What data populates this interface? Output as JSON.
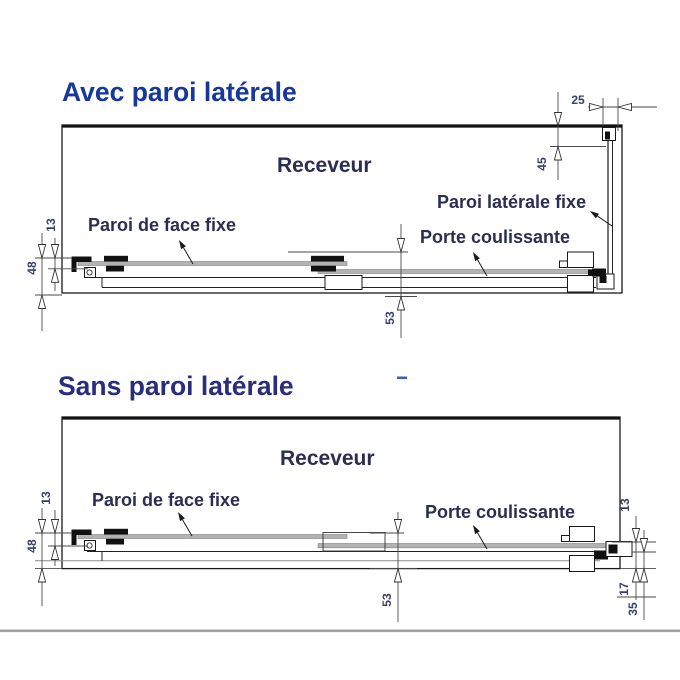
{
  "diagrams": {
    "top": {
      "title": "Avec paroi latérale",
      "tray_label": "Receveur",
      "front_panel_label": "Paroi de face fixe",
      "sliding_door_label": "Porte coulissante",
      "side_panel_label": "Paroi latérale fixe",
      "dimensions": {
        "side_offset": "25",
        "side_inset": "45",
        "wall_gap": "13",
        "wall_total": "48",
        "front_depth": "53"
      }
    },
    "bottom": {
      "title": "Sans paroi latérale",
      "tray_label": "Receveur",
      "front_panel_label": "Paroi de face fixe",
      "sliding_door_label": "Porte coulissante",
      "dimensions": {
        "wall_gap": "13",
        "wall_total": "48",
        "front_depth": "53",
        "right_gap": "13",
        "right_inset": "17",
        "right_total": "35"
      }
    }
  },
  "colors": {
    "title_top": "#15389a",
    "title_bottom": "#2a2d7c",
    "label_text": "#2b2e52",
    "dimension_text": "#39406e",
    "glass_gray": "#b3b3b3",
    "line_black": "#1a1a1a",
    "footer_band": "#a2a2a2"
  }
}
